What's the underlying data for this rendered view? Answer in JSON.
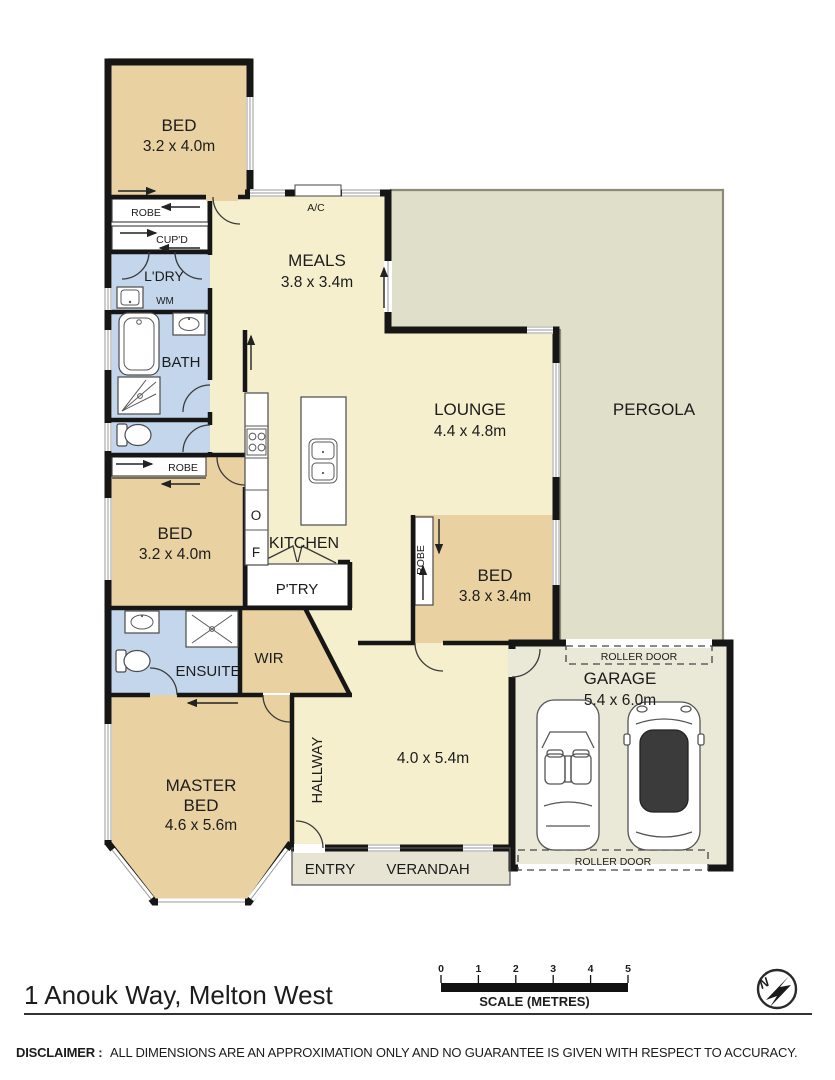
{
  "rooms": {
    "bed1": {
      "name": "BED",
      "dims": "3.2 x 4.0m"
    },
    "bed2": {
      "name": "BED",
      "dims": "3.2 x 4.0m"
    },
    "bed3": {
      "name": "BED",
      "dims": "3.8 x 3.4m"
    },
    "master_bed": {
      "line1": "MASTER",
      "line2": "BED",
      "dims": "4.6 x 5.6m"
    },
    "meals": {
      "name": "MEALS",
      "dims": "3.8 x 3.4m"
    },
    "lounge": {
      "name": "LOUNGE",
      "dims": "4.4 x 4.8m"
    },
    "family": {
      "dims": "4.0 x 5.4m"
    },
    "kitchen": {
      "name": "KITCHEN"
    },
    "pantry": {
      "name": "P'TRY"
    },
    "laundry": {
      "name": "L'DRY"
    },
    "bath": {
      "name": "BATH"
    },
    "ensuite": {
      "name": "ENSUITE"
    },
    "wir": {
      "name": "WIR"
    },
    "hallway": {
      "name": "HALLWAY"
    },
    "entry": {
      "name": "ENTRY"
    },
    "verandah": {
      "name": "VERANDAH"
    },
    "pergola": {
      "name": "PERGOLA"
    },
    "garage": {
      "name": "GARAGE",
      "dims": "5.4 x 6.0m"
    }
  },
  "fixtures": {
    "robe1": "ROBE",
    "robe2": "ROBE",
    "robe3": "ROBE",
    "cupboard": "CUP'D",
    "wm": "WM",
    "ac_unit": "A/C",
    "oven": "O",
    "fridge": "F",
    "roller_door_top": "ROLLER DOOR",
    "roller_door_bottom": "ROLLER DOOR"
  },
  "scale_bar": {
    "ticks": [
      "0",
      "1",
      "2",
      "3",
      "4",
      "5"
    ],
    "label": "SCALE (METRES)"
  },
  "compass": {
    "north": "N"
  },
  "footer": {
    "address": "1 Anouk Way, Melton West",
    "disclaimer_label": "DISCLAIMER :",
    "disclaimer_text": "ALL DIMENSIONS ARE AN APPROXIMATION ONLY AND NO GUARANTEE IS GIVEN WITH RESPECT TO ACCURACY."
  },
  "colors": {
    "bedroom_fill": "#e9d1a1",
    "living_fill": "#f5efcd",
    "wet_area_fill": "#c3d6ec",
    "pergola_fill": "#e0dfc9",
    "garage_fill": "#eae9d8",
    "verandah_fill": "#e8e4d4",
    "wall": "#161616"
  }
}
